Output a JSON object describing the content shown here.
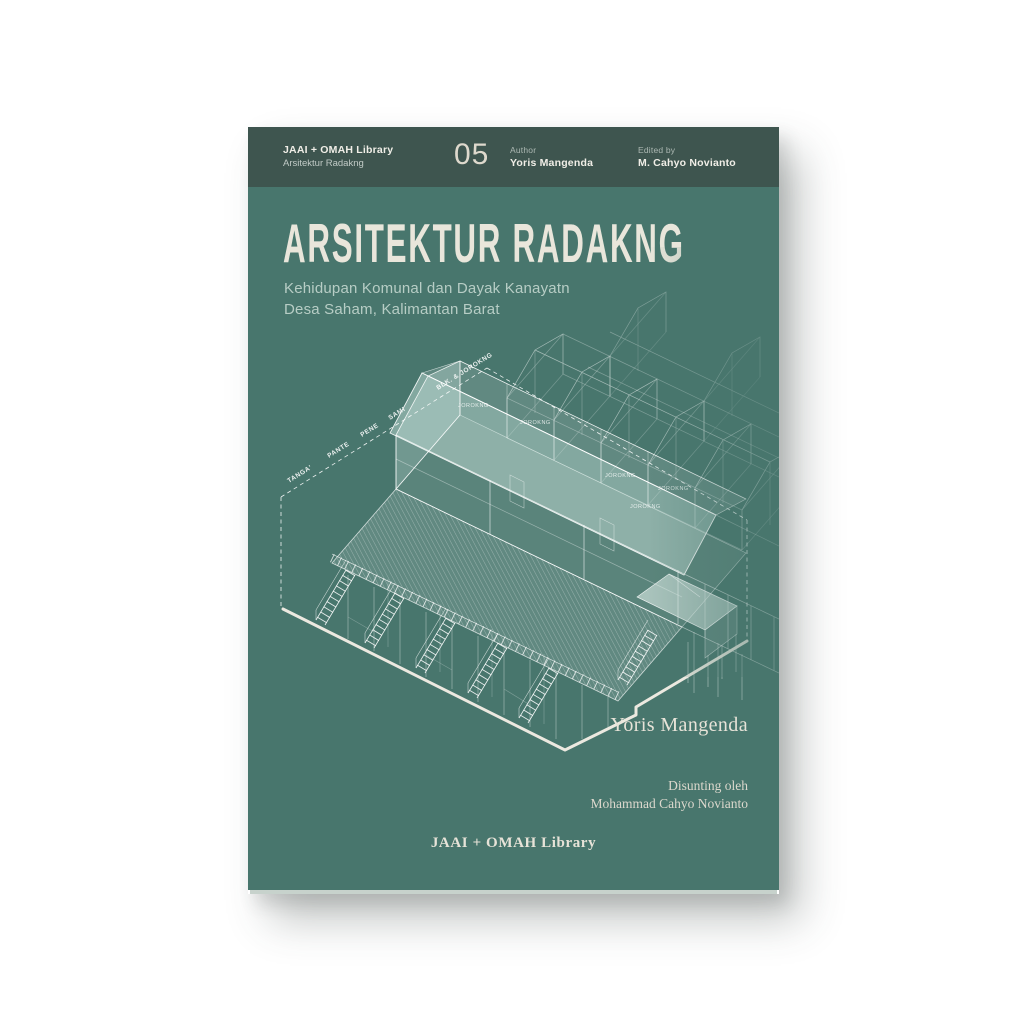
{
  "page": {
    "background": "#ffffff"
  },
  "cover": {
    "colors": {
      "band": "#3e554f",
      "cover": "#48766d",
      "title": "#e9e6db",
      "subtitle": "#b7cdc5",
      "drawing_line": "#ffffff",
      "page_edge": "#c7d2cc"
    },
    "header": {
      "series_label": "JAAI + OMAH Library",
      "series_sublabel": "Arsitektur Radakng",
      "issue_number": "05",
      "author_label": "Author",
      "author_name": "Yoris Mangenda",
      "editor_label": "Edited by",
      "editor_name": "M. Cahyo Novianto"
    },
    "title": "ARSITEKTUR RADAKNG",
    "subtitle_line1": "Kehidupan Komunal dan Dayak Kanayatn",
    "subtitle_line2": "Desa Saham, Kalimantan Barat",
    "drawing": {
      "axis_labels": [
        "TANGA'",
        "PANTE",
        "PENE",
        "SAMI",
        "BLK. & JOROKNG"
      ],
      "room_labels": [
        "JOROKNG",
        "JOROKNG",
        "JOROKNG",
        "JOROKNG",
        "JOROKNG"
      ]
    },
    "signature": "Yoris Mangenda",
    "credit_line1": "Disunting oleh",
    "credit_line2": "Mohammad Cahyo Novianto",
    "publisher": "JAAI + OMAH Library"
  }
}
